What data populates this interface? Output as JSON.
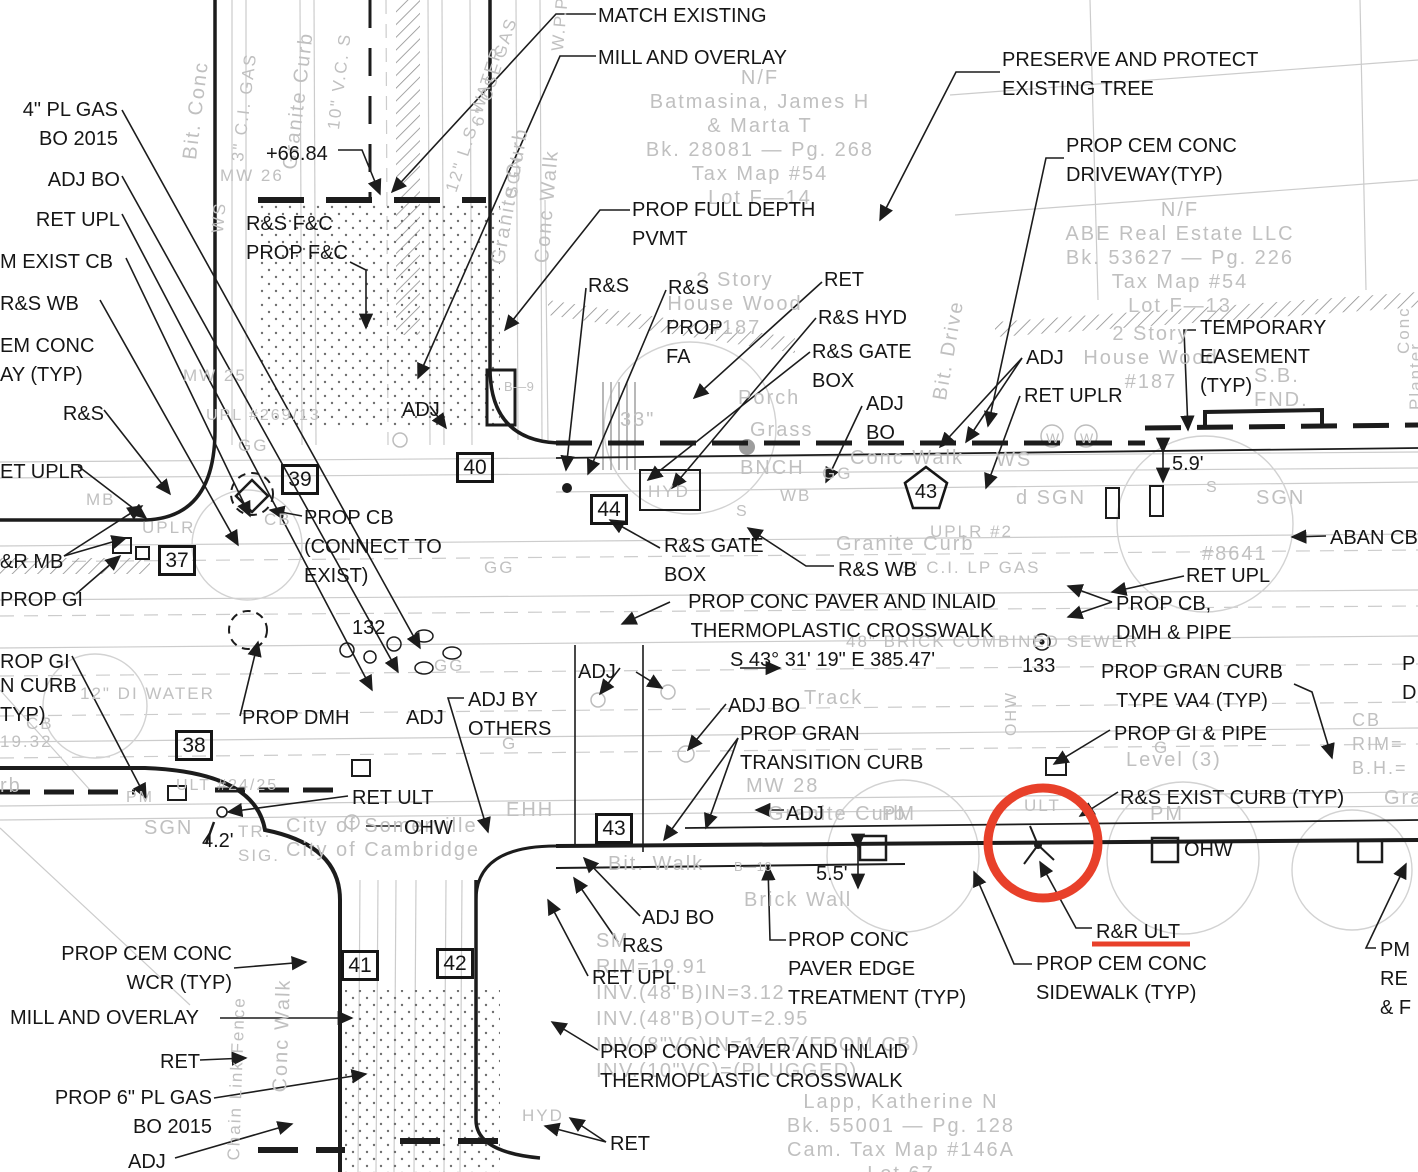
{
  "annotation": {
    "highlight_color": "#e8402a",
    "highlighted_label": "R&R ULT"
  },
  "stations": {
    "boxed": [
      "37",
      "38",
      "39",
      "40",
      "41",
      "42",
      "43",
      "44"
    ],
    "pentagon": "43"
  },
  "callouts": [
    {
      "text": "MATCH EXISTING"
    },
    {
      "text": "MILL AND OVERLAY"
    },
    {
      "text": "PRESERVE AND PROTECT\nEXISTING TREE"
    },
    {
      "text": "4\" PL GAS\nBO 2015"
    },
    {
      "text": "ADJ BO"
    },
    {
      "text": "RET UPL"
    },
    {
      "text": "M EXIST CB"
    },
    {
      "text": "R&S WB"
    },
    {
      "text": "EM CONC\nAY (TYP)"
    },
    {
      "text": "R&S"
    },
    {
      "text": "ET UPLR"
    },
    {
      "text": "&R MB"
    },
    {
      "text": "PROP GI"
    },
    {
      "text": "ROP GI"
    },
    {
      "text": "N CURB\nTYP)"
    },
    {
      "text": "R&S F&C\nPROP F&C"
    },
    {
      "text": "+66.84"
    },
    {
      "text": "PROP FULL DEPTH\nPVMT"
    },
    {
      "text": "R&S"
    },
    {
      "text": "R&S"
    },
    {
      "text": "PROP\nFA"
    },
    {
      "text": "RET"
    },
    {
      "text": "R&S HYD"
    },
    {
      "text": "R&S GATE\nBOX"
    },
    {
      "text": "ADJ\nBO"
    },
    {
      "text": "PROP CEM CONC\nDRIVEWAY(TYP)"
    },
    {
      "text": "ADJ"
    },
    {
      "text": "RET UPLR"
    },
    {
      "text": "TEMPORARY\nEASEMENT\n(TYP)"
    },
    {
      "text": "5.9'"
    },
    {
      "text": "ABAN CB"
    },
    {
      "text": "RET UPL"
    },
    {
      "text": "PROP CB,\nDMH & PIPE"
    },
    {
      "text": "ADJ"
    },
    {
      "text": "PROP CB\n(CONNECT TO\nEXIST)"
    },
    {
      "text": "132"
    },
    {
      "text": "R&S GATE\nBOX"
    },
    {
      "text": "R&S WB"
    },
    {
      "text": "PROP CONC PAVER AND INLAID\nTHERMOPLASTIC CROSSWALK"
    },
    {
      "text": "S 43° 31' 19\" E   385.47'"
    },
    {
      "text": "133"
    },
    {
      "text": "PROP GRAN CURB\nTYPE VA4 (TYP)"
    },
    {
      "text": "PROP GI & PIPE"
    },
    {
      "text": "R&S EXIST CURB (TYP)"
    },
    {
      "text": "OHW"
    },
    {
      "text": "ADJ"
    },
    {
      "text": "ADJ BY\nOTHERS"
    },
    {
      "text": "ADJ"
    },
    {
      "text": "ADJ BO"
    },
    {
      "text": "PROP GRAN\nTRANSITION CURB"
    },
    {
      "text": "RET ULT"
    },
    {
      "text": "OHW"
    },
    {
      "text": "4.2'"
    },
    {
      "text": "ADJ"
    },
    {
      "text": "5.5'"
    },
    {
      "text": "R&R ULT"
    },
    {
      "text": "PROP CEM CONC\nSIDEWALK (TYP)"
    },
    {
      "text": "PROP CONC\nPAVER EDGE\nTREATMENT (TYP)"
    },
    {
      "text": "ADJ BO"
    },
    {
      "text": "R&S"
    },
    {
      "text": "RET UPL"
    },
    {
      "text": "PROP CONC PAVER AND INLAID\nTHERMOPLASTIC CROSSWALK"
    },
    {
      "text": "RET"
    },
    {
      "text": "PROP CEM CONC\nWCR (TYP)"
    },
    {
      "text": "MILL AND OVERLAY"
    },
    {
      "text": "RET"
    },
    {
      "text": "PROP 6\" PL GAS\nBO 2015"
    },
    {
      "text": "ADJ"
    },
    {
      "text": "PROP DMH"
    },
    {
      "text": "PM\nRE\n& F"
    },
    {
      "text": "P\nD"
    }
  ],
  "existing": [
    {
      "text": "N/F\nBatmasina,  James  H\n&  Marta  T\nBk.  28081  —  Pg.  268\nTax  Map  #54\nLot  F—14"
    },
    {
      "text": "N/F\nABE  Real  Estate  LLC\nBk.  53627  —  Pg.  226\nTax  Map  #54\nLot  F—13"
    },
    {
      "text": "2  Story\nHouse  Wood\n#187"
    },
    {
      "text": "2  Story\nHouse  Wood\n#187"
    },
    {
      "text": "S.B.\nFND."
    },
    {
      "text": "Porch"
    },
    {
      "text": "Grass"
    },
    {
      "text": "33\""
    },
    {
      "text": "BNCH"
    },
    {
      "text": "Conc  Walk"
    },
    {
      "text": "WS"
    },
    {
      "text": "Granite  Curb"
    },
    {
      "text": "3\"  C.I.  LP  GAS"
    },
    {
      "text": "UPLR  #2"
    },
    {
      "text": "d  SGN"
    },
    {
      "text": "SGN"
    },
    {
      "text": "#8641"
    },
    {
      "text": "Level  (3)"
    },
    {
      "text": "CB\nRIM=\nB.H.="
    },
    {
      "text": "Gran"
    },
    {
      "text": "PM"
    },
    {
      "text": "PM"
    },
    {
      "text": "MW  28"
    },
    {
      "text": "Granite  Curb"
    },
    {
      "text": "Bit.  Walk"
    },
    {
      "text": "Brick  Wall"
    },
    {
      "text": "Track"
    },
    {
      "text": "48\"  BRICK  COMBINED  SEWER"
    },
    {
      "text": "12\"  DI  WATER"
    },
    {
      "text": "City  of  Somerville\nCity  of  Cambridge"
    },
    {
      "text": "EHH"
    },
    {
      "text": "SGN"
    },
    {
      "text": "TR.\nSIG."
    },
    {
      "text": "PM"
    },
    {
      "text": "ULT  #24/25"
    },
    {
      "text": "19.32"
    },
    {
      "text": "CB"
    },
    {
      "text": "rb"
    },
    {
      "text": "MB"
    },
    {
      "text": "UPLR"
    },
    {
      "text": "UPL  #269/13"
    },
    {
      "text": "MW  25"
    },
    {
      "text": "MW  26"
    },
    {
      "text": "CB"
    },
    {
      "text": "HYD"
    },
    {
      "text": "WB"
    },
    {
      "text": "SM\nRIM=19.91\nINV.(48\"B)IN=3.12\nINV.(48\"B)OUT=2.95\nINV.(8\"VC)IN=14.07(FROM  CB)\nINV.(10\"VC)=(PLUGGED)"
    },
    {
      "text": "Lapp,  Katherine  N\nBk.  55001  —  Pg.  128\nCam.  Tax  Map  #146A\nLot  67"
    },
    {
      "text": "HYD"
    },
    {
      "text": "B—9"
    },
    {
      "text": "B—10"
    },
    {
      "text": "GG"
    },
    {
      "text": "GG"
    },
    {
      "text": "GG"
    },
    {
      "text": "GG"
    },
    {
      "text": "G"
    },
    {
      "text": "G"
    },
    {
      "text": "S"
    },
    {
      "text": "S"
    },
    {
      "text": "W"
    },
    {
      "text": "W"
    },
    {
      "text": "ULT"
    }
  ],
  "rotated": [
    {
      "text": "Bit.  Conc"
    },
    {
      "text": "3\"  C.I.  GAS"
    },
    {
      "text": "Granite  Curb"
    },
    {
      "text": "10\"  V.C.  S"
    },
    {
      "text": "12\"  L.S.  WATER"
    },
    {
      "text": "6\"  CSL  GAS"
    },
    {
      "text": "Granite  Curb"
    },
    {
      "text": "SGN"
    },
    {
      "text": "Conc  Walk"
    },
    {
      "text": "W.P.P."
    },
    {
      "text": "Conc  Walk"
    },
    {
      "text": "Planter"
    },
    {
      "text": "Bit.  Drive"
    },
    {
      "text": "Conc  Walk"
    },
    {
      "text": "Chain  Link  Fence"
    },
    {
      "text": "WS"
    },
    {
      "text": "OHW"
    }
  ]
}
